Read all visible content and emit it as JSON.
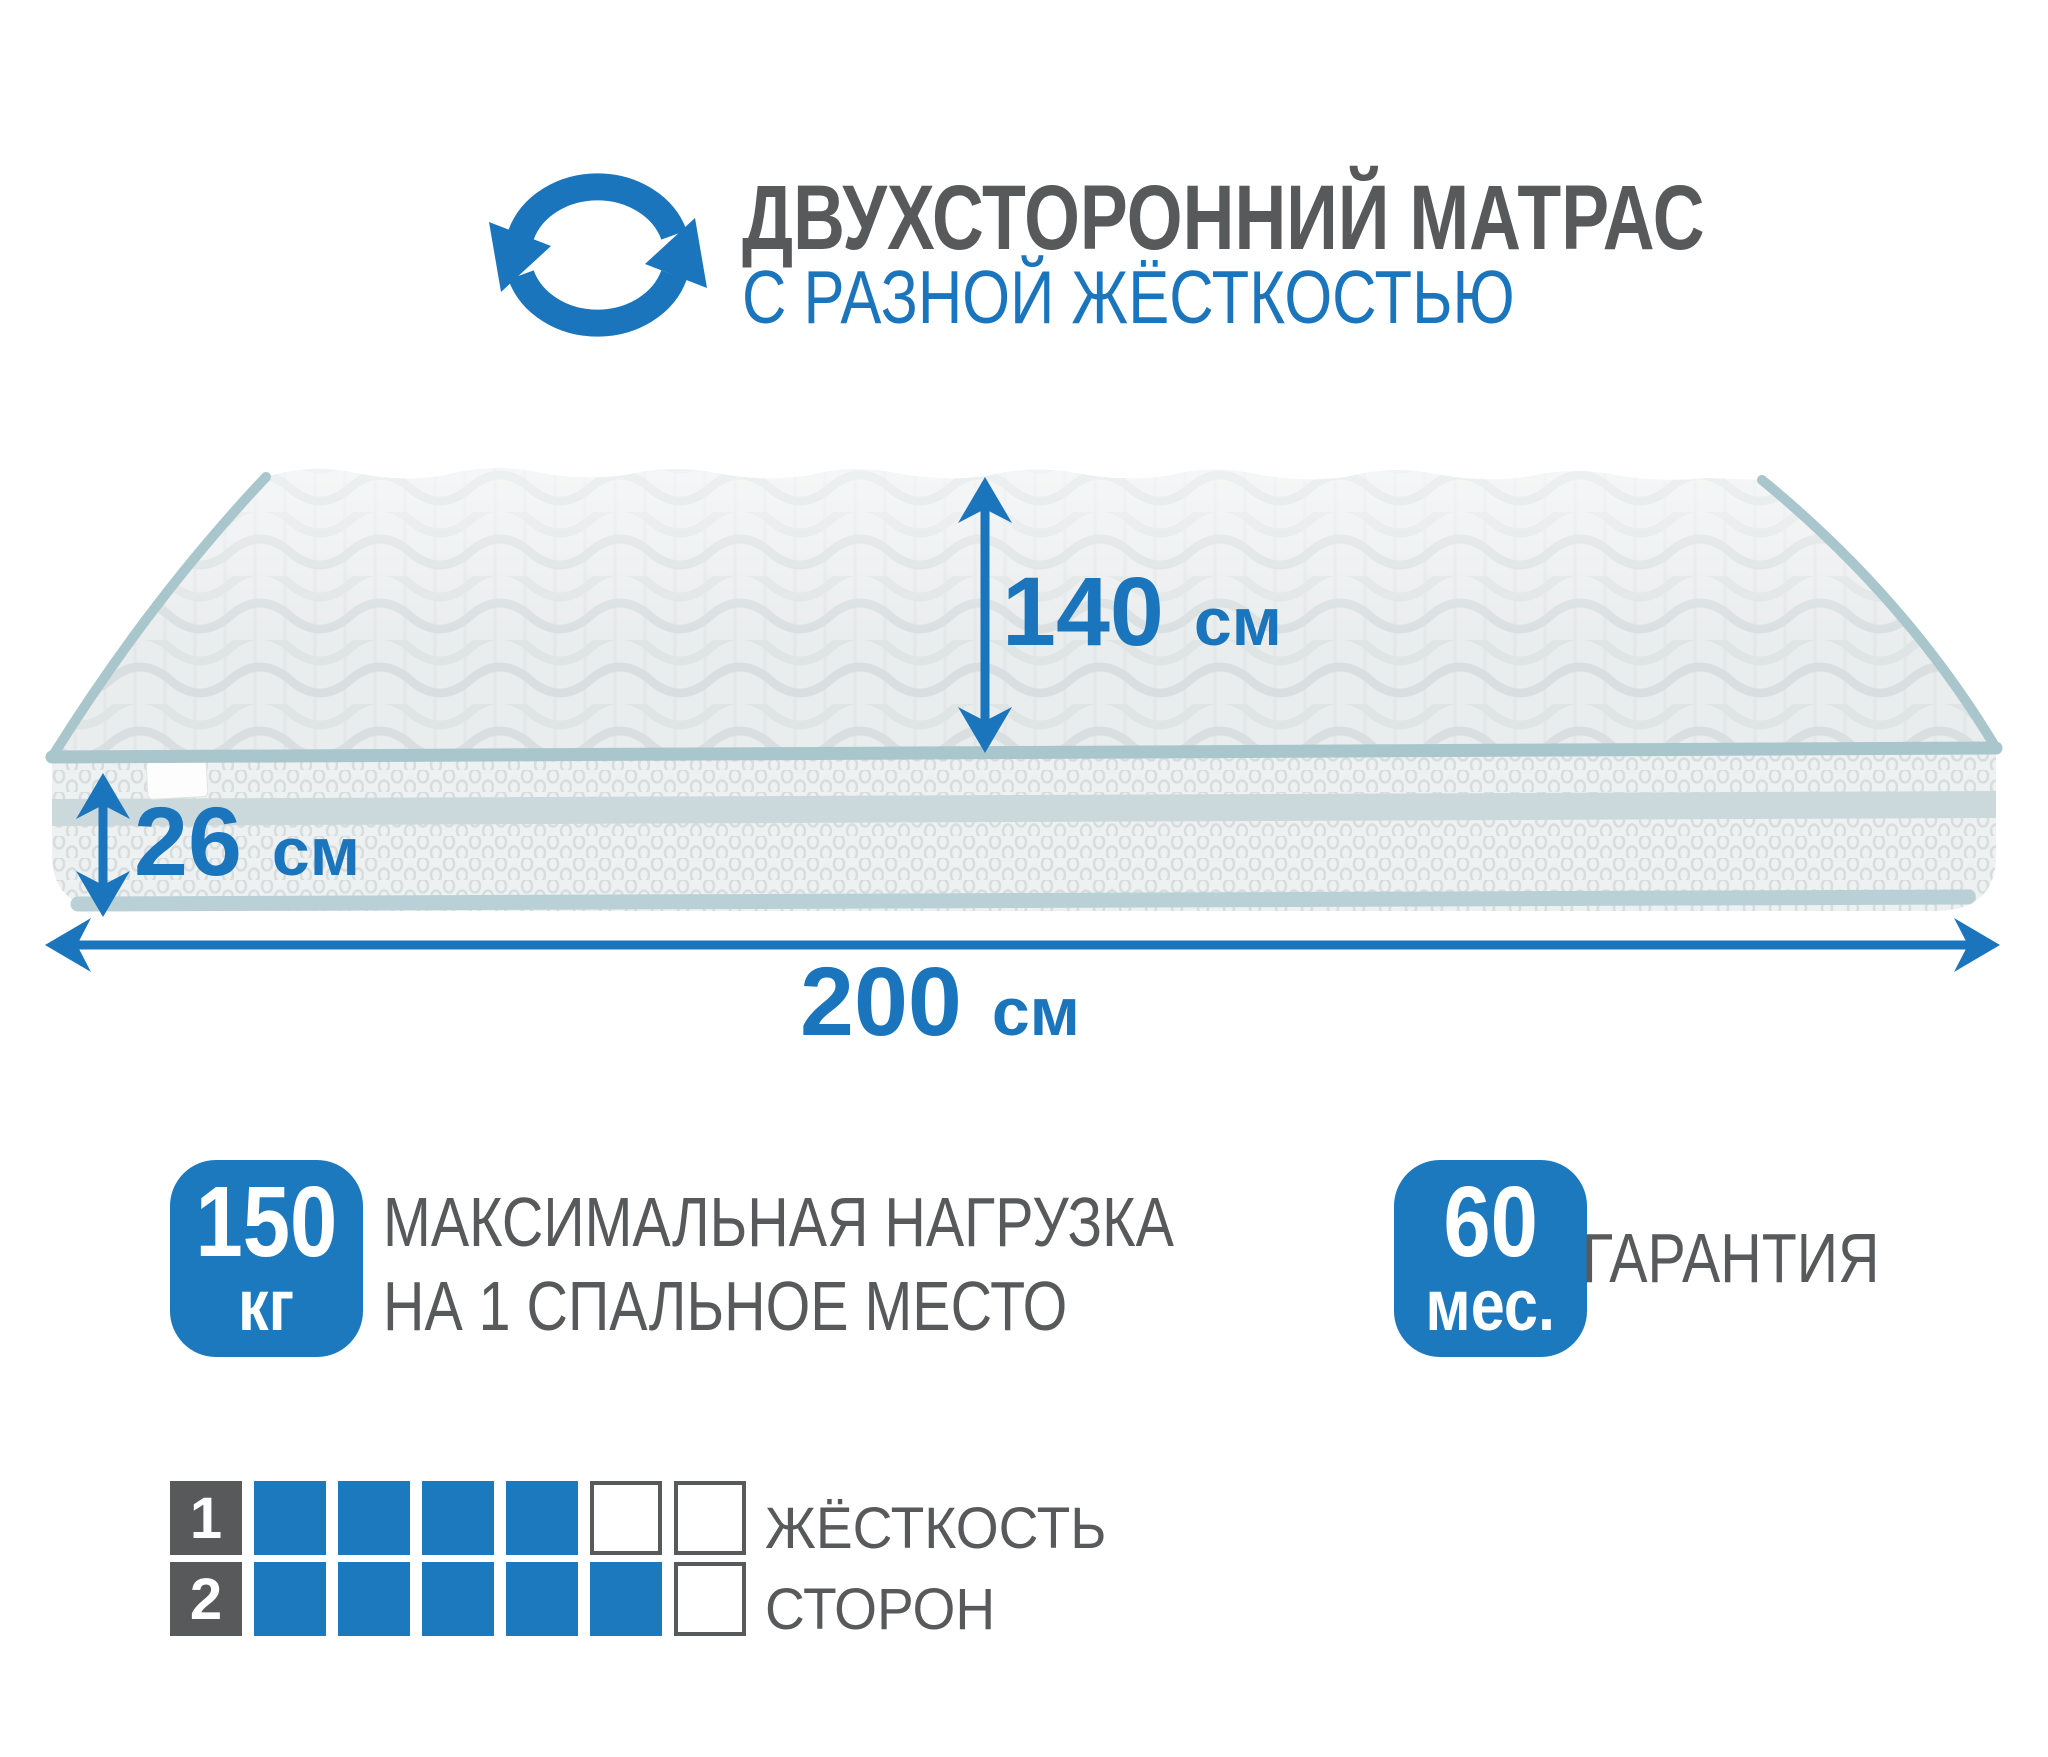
{
  "colors": {
    "accent_blue": "#1b75bc",
    "badge_blue": "#1d79be",
    "text_gray": "#58595b",
    "piping_blue": "#a8c6cc",
    "mattress_top": "#eaedee",
    "mattress_side": "#eef1f2"
  },
  "header": {
    "title": "ДВУХСТОРОННИЙ МАТРАС",
    "subtitle": "С РАЗНОЙ ЖЁСТКОСТЬЮ",
    "icon": "rotate-arrows-icon"
  },
  "dimensions": {
    "width": {
      "value": "140",
      "unit": "см"
    },
    "thickness": {
      "value": "26",
      "unit": "см"
    },
    "length": {
      "value": "200",
      "unit": "см"
    }
  },
  "max_load": {
    "value": "150",
    "unit": "кг",
    "label_line1": "МАКСИМАЛЬНАЯ НАГРУЗКА",
    "label_line2": "НА 1 СПАЛЬНОЕ МЕСТО"
  },
  "warranty": {
    "value": "60",
    "unit": "мес.",
    "label": "ГАРАНТИЯ"
  },
  "firmness": {
    "caption_line1": "ЖЁСТКОСТЬ",
    "caption_line2": "СТОРОН",
    "scale_max": 6,
    "rows": [
      {
        "label": "1",
        "filled": 4
      },
      {
        "label": "2",
        "filled": 5
      }
    ]
  }
}
